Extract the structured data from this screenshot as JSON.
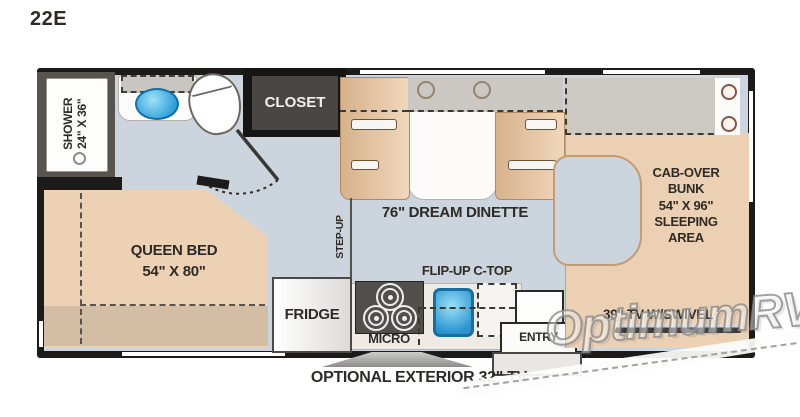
{
  "plan": {
    "code": "22E"
  },
  "labels": {
    "shower": "SHOWER\n24\" X 36\"",
    "closet": "CLOSET",
    "dinette": "76\" DREAM DINETTE",
    "step_up": "STEP-UP",
    "queen_bed": "QUEEN BED\n54\" X 80\"",
    "cab_over_bunk": "CAB-OVER\nBUNK\n54\" X 96\"\nSLEEPING\nAREA",
    "fridge": "FRIDGE",
    "micro": "MICRO",
    "flip_up_ctop": "FLIP-UP C-TOP",
    "entry": "ENTRY",
    "tv_swivel": "39\" TV W/SWIVEL",
    "exterior_tv": "OPTIONAL EXTERIOR 32\" TV"
  },
  "watermark": {
    "text": "OptimumRV"
  },
  "icons": {
    "toilet": "toilet-icon",
    "sink": "sink-icon",
    "kitchen_sink": "kitchen-sink-icon",
    "stove_burner": "stove-burner-icon",
    "door_swing": "door-swing-icon",
    "tv": "tv-icon",
    "exterior_tv": "exterior-tv-icon",
    "shower_drain": "shower-drain-icon",
    "cup_holder": "cup-holder-icon",
    "grommet": "grommet-icon",
    "window": "window-strip"
  },
  "colors": {
    "wall": "#1d1b19",
    "floor": "#ccd5dd",
    "furniture_tan": "#ecd0b3",
    "bench_shadow": "#d7b28b",
    "gray_fixture": "#cbc7c2",
    "sink_blue": "#2d9fd9",
    "closet_fill": "#494744",
    "label_text": "#2e2b27"
  }
}
